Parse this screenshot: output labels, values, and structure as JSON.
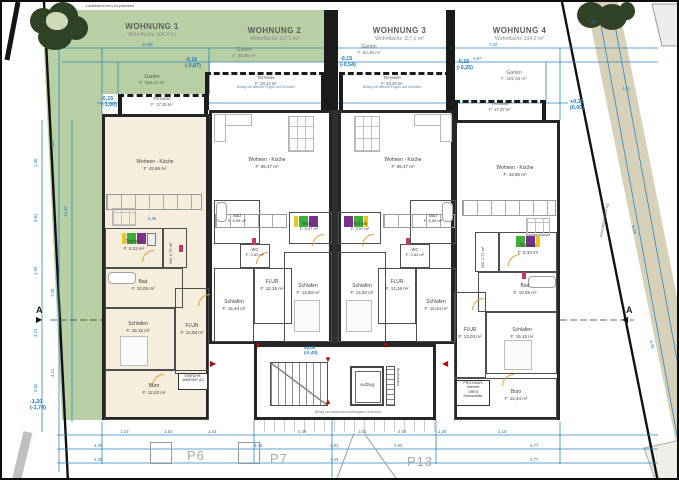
{
  "site": {
    "tree_note": "Laubbaum neu zu pflanzen",
    "boundary_label": "Grundstücksgrenze",
    "section_marker": "A",
    "parcels": [
      "P6",
      "P7",
      "P13"
    ],
    "stair_note": "Belag auf wasserdurchlässigem Unterbau",
    "terrace_note": "Belag mit offenen Fugen auf Schotter"
  },
  "core": {
    "aufzug": "Aufzug",
    "briefkaesten": "Briefkästen",
    "proximus": [
      "PROXIMUS",
      "Internet",
      "ORES",
      "Stromzähler"
    ],
    "wasser": [
      "EINFÜHR.",
      "WASSER (D)"
    ]
  },
  "elevations": {
    "e1a": "-0,15",
    "e1b": "(-1,00)",
    "e2a": "-0,15",
    "e2b": "(-0,87)",
    "e3a": "-0,15",
    "e3b": "(-0,54)",
    "e4a": "-0,15",
    "e4b": "(-0,25)",
    "e5a": "+0,15",
    "e5b": "(0,00)",
    "e6a": "-1,20",
    "e6b": "(-1,74)",
    "e7a": "±0,00",
    "e7b": "(-0,43)"
  },
  "apartments": {
    "w1": {
      "title": "WOHNUNG 1",
      "subtitle": "Wohnfläche 104,2 m²",
      "garden_name": "Garten",
      "garden_area": "F: 162,27 m²",
      "terrace_name": "Terrasse",
      "terrace_area": "F: 17,28 m²",
      "rooms": {
        "wohnen": {
          "name": "Wohnen - Küche",
          "area": "F: 42,86 m²"
        },
        "technik": {
          "name": "Technik",
          "area": "F: 8,22 m²"
        },
        "wc": {
          "name": "WC",
          "area": "2,72 m²"
        },
        "bad": {
          "name": "Bad",
          "area": "F: 10,05 m²"
        },
        "schlafen": {
          "name": "Schlafen",
          "area": "F: 15,15 m²"
        },
        "flur": {
          "name": "FLUR",
          "area": "F: 13,08 m²"
        },
        "buero": {
          "name": "Büro",
          "area": "F: 12,83 m²"
        }
      }
    },
    "w2": {
      "title": "WOHNUNG 2",
      "subtitle": "Wohnfläche 117,1 m²",
      "garden_name": "Garten",
      "garden_area": "F: 48,85 m²",
      "terrace_name": "Terrasse",
      "terrace_area": "F: 23,14 m²",
      "rooms": {
        "wohnen": {
          "name": "Wohnen - Küche",
          "area": "F: 55,47 m²"
        },
        "technik": {
          "name": "Technik",
          "area": "F: 5,97 m²"
        },
        "bad": {
          "name": "Bad",
          "area": "F: 8,08 m²"
        },
        "wc": {
          "name": "WC",
          "area": "F: 4,63 m²"
        },
        "flur": {
          "name": "FLUR",
          "area": "F: 12,26 m²"
        },
        "schlafen1": {
          "name": "Schlafen",
          "area": "F: 15,44 m²"
        },
        "schlafen2": {
          "name": "Schlafen",
          "area": "F: 14,50 m²"
        }
      }
    },
    "w3": {
      "title": "WOHNUNG 3",
      "subtitle": "Wohnfläche 117,1 m²",
      "garden_name": "Garten",
      "garden_area": "F: 52,38 m²",
      "terrace_name": "Terrasse",
      "terrace_area": "F: 23,29 m²",
      "rooms": {
        "wohnen": {
          "name": "Wohnen - Küche",
          "area": "F: 55,47 m²"
        },
        "technik": {
          "name": "Technik",
          "area": "F: 5,97 m²"
        },
        "bad": {
          "name": "Bad",
          "area": "F: 8,08 m²"
        },
        "wc": {
          "name": "WC",
          "area": "F: 4,63 m²"
        },
        "flur": {
          "name": "FLUR",
          "area": "F: 12,26 m²"
        },
        "schlafen1": {
          "name": "Schlafen",
          "area": "F: 14,50 m²"
        },
        "schlafen2": {
          "name": "Schlafen",
          "area": "F: 15,44 m²"
        }
      }
    },
    "w4": {
      "title": "WOHNUNG 4",
      "subtitle": "Wohnfläche 104,2 m²",
      "garden_name": "Garten",
      "garden_area": "F: 202,65 m²",
      "terrace_name": "Terrasse",
      "terrace_area": "F: 17,37 m²",
      "rooms": {
        "wohnen": {
          "name": "Wohnen - Küche",
          "area": "F: 42,86 m²"
        },
        "technik": {
          "name": "Technik",
          "area": "F: 8,33 m²"
        },
        "wc": {
          "name": "WC",
          "area": "2,72 m²"
        },
        "bad": {
          "name": "Bad",
          "area": "F: 10,05 m²"
        },
        "schlafen": {
          "name": "Schlafen",
          "area": "F: 15,15 m²"
        },
        "flur": {
          "name": "FLUR",
          "area": "F: 13,03 m²"
        },
        "buero": {
          "name": "Büro",
          "area": "F: 12,44 m²"
        }
      }
    }
  },
  "dims": {
    "top": [
      "14,96",
      "7,32",
      "4,87",
      "4,30"
    ],
    "left70": [
      "14,43"
    ],
    "left57": [
      "3,87",
      "7,35",
      "4,21"
    ],
    "left40": [
      "1,35",
      "3,81",
      "1,93",
      "4,21",
      "2,02"
    ],
    "right": [
      "1,87",
      "6,33",
      "6,36"
    ],
    "inner": [
      "5,36"
    ],
    "b1": [
      "1,10",
      "1,52",
      "1,43",
      "3,48",
      "1,01",
      "2,02",
      "1,26",
      "1,10"
    ],
    "b2": [
      "4,39",
      "3,48",
      "1,81",
      "2,02",
      "4,77"
    ],
    "b3": [
      "4,39",
      "7,44",
      "4,77"
    ]
  }
}
